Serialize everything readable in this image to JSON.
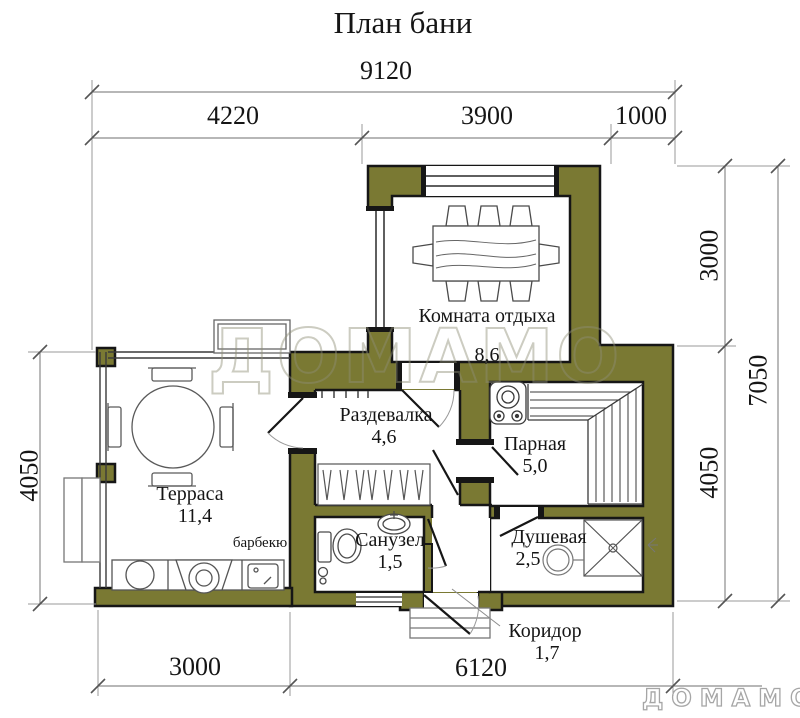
{
  "title": "План бани",
  "dims": {
    "top_total": "9120",
    "top_seg1": "4220",
    "top_seg2": "3900",
    "top_seg3": "1000",
    "right_upper": "3000",
    "right_total": "7050",
    "right_lower": "4050",
    "left_height": "4050",
    "bottom_left": "3000",
    "bottom_right": "6120"
  },
  "rooms": {
    "rest": {
      "name": "Комната отдыха",
      "area": "8,6"
    },
    "dressing": {
      "name": "Раздевалка",
      "area": "4,6"
    },
    "steam": {
      "name": "Парная",
      "area": "5,0"
    },
    "terrace": {
      "name": "Терраса",
      "area": "11,4"
    },
    "wc": {
      "name": "Санузел",
      "area": "1,5"
    },
    "shower": {
      "name": "Душевая",
      "area": "2,5"
    },
    "corridor": {
      "name": "Коридор",
      "area": "1,7"
    }
  },
  "labels": {
    "barbecue": "барбекю"
  },
  "watermark": {
    "center": "ДОМАМО",
    "corner": "ДОМАМО"
  },
  "colors": {
    "wall": "#7a7933",
    "outline": "#161616",
    "dimline": "#8c8c8c",
    "furniture": "#555555"
  }
}
